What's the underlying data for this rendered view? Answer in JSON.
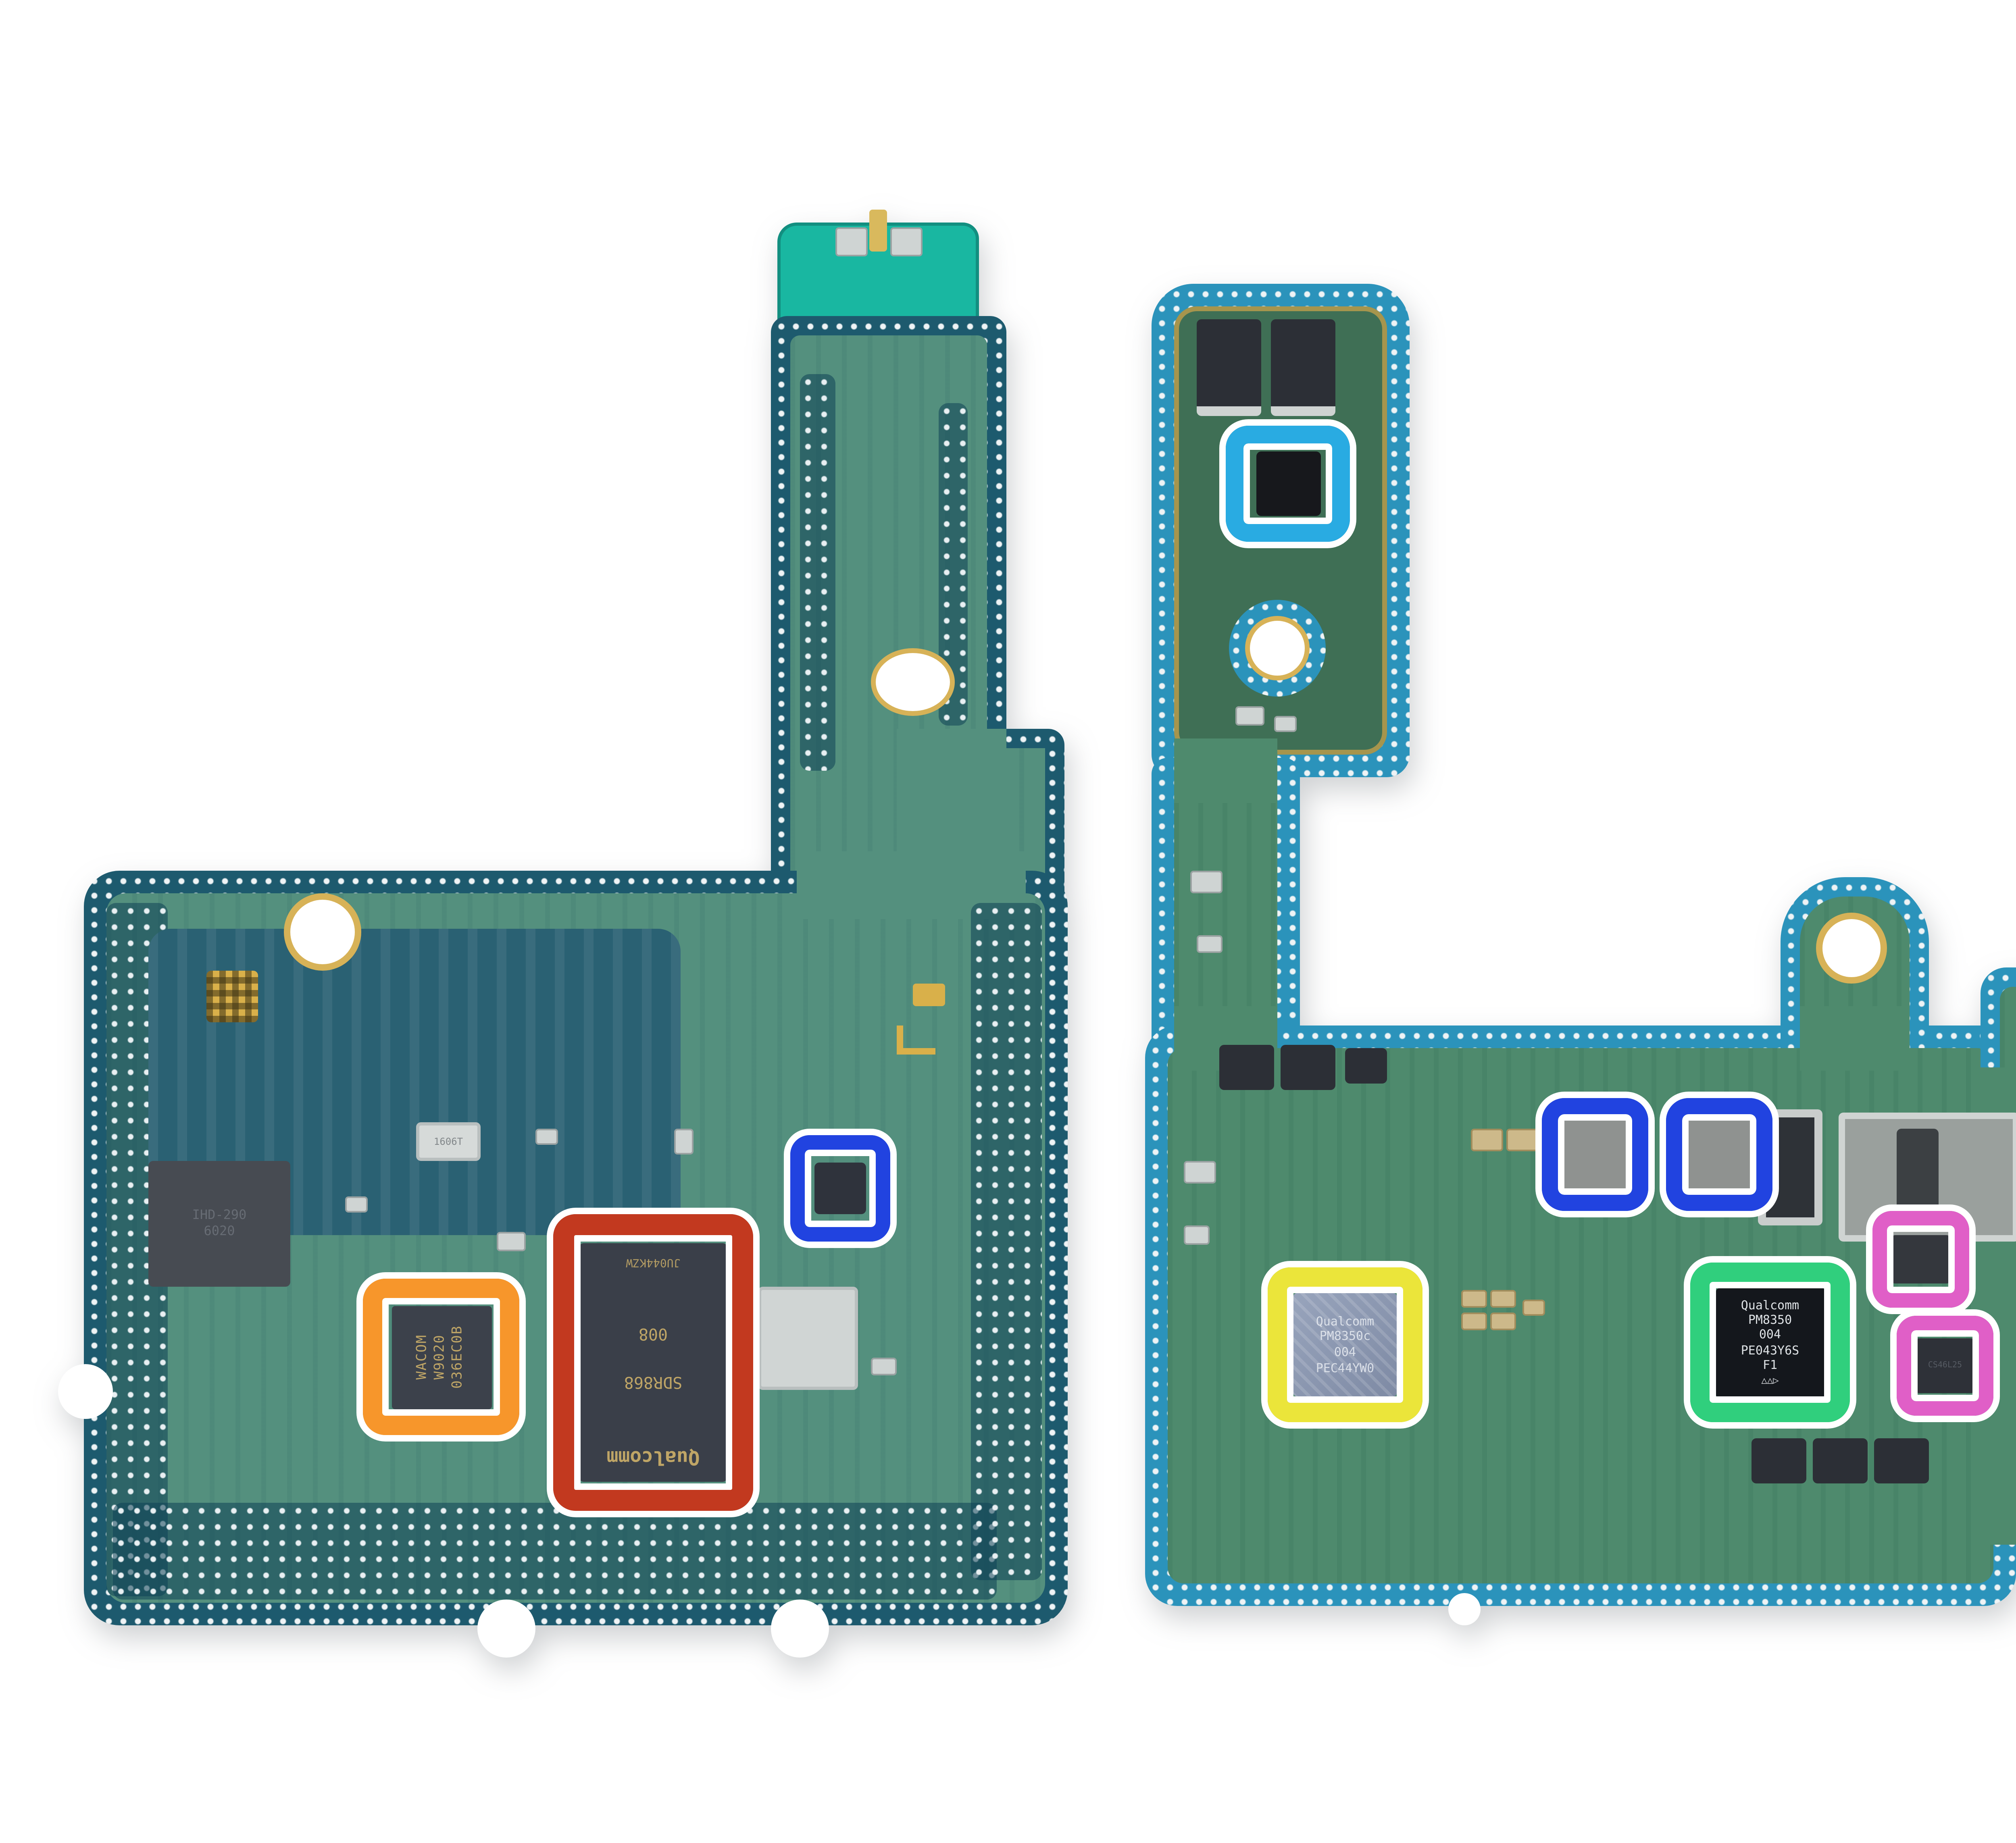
{
  "meta": {
    "description": "Teardown photo of two smartphone logic-board sections on a white background with colored rectangle callouts highlighting chips"
  },
  "palette": {
    "background": "#ffffff",
    "left_board_core": "#54907e",
    "left_board_edge": "#1d5a6e",
    "left_board_tip": "#19b7a1",
    "right_board_core": "#4e8a6d",
    "right_board_edge": "#2b93bb",
    "flex_core": "#5d8a55",
    "flex_dark": "#46621f",
    "gold": "#d2a547"
  },
  "callouts": [
    {
      "id": "orange",
      "color": "#F7962B",
      "css": "border-color:#F7962B"
    },
    {
      "id": "red",
      "color": "#C2391F",
      "css": "border-color:#C2391F"
    },
    {
      "id": "blue-left",
      "color": "#2143E0",
      "css": "border-color:#2143E0"
    },
    {
      "id": "cyan",
      "color": "#29ABE2",
      "css": "border-color:#29ABE2"
    },
    {
      "id": "blue-right-1",
      "color": "#2143E0",
      "css": "border-color:#2143E0"
    },
    {
      "id": "blue-right-2",
      "color": "#2143E0",
      "css": "border-color:#2143E0"
    },
    {
      "id": "yellow",
      "color": "#EBE53A",
      "css": "border-color:#EBE53A"
    },
    {
      "id": "green",
      "color": "#30CF7D",
      "css": "border-color:#30CF7D"
    },
    {
      "id": "pink-1",
      "color": "#E05FC7",
      "css": "border-color:#E05FC7"
    },
    {
      "id": "pink-2",
      "color": "#E05FC7",
      "css": "border-color:#E05FC7"
    }
  ],
  "chips": {
    "wacom": {
      "marking": "WACOM\nW9020\n036EC0B"
    },
    "sdr": {
      "brand": "Qualcomm",
      "part": "SDR868",
      "num": "008",
      "lot": "JU044KZW"
    },
    "pm8350c": {
      "marking": "Qualcomm\nPM8350c\n004\nPEC44YW0"
    },
    "pm8350": {
      "marking": "Qualcomm\nPM8350\n004\nPE043Y6S\nF1",
      "symbols": "△△▷"
    },
    "audio": {
      "marking": "CS46L25"
    },
    "misc": {
      "marking": "IHD-290\n6020"
    },
    "crystal": {
      "marking": "1606T"
    }
  },
  "silkscreen": {
    "model": "SM-G998U/V/0/D",
    "rev": "V90",
    "code": "06A",
    "connector": "L0C167",
    "mic": "048\nAQC"
  }
}
